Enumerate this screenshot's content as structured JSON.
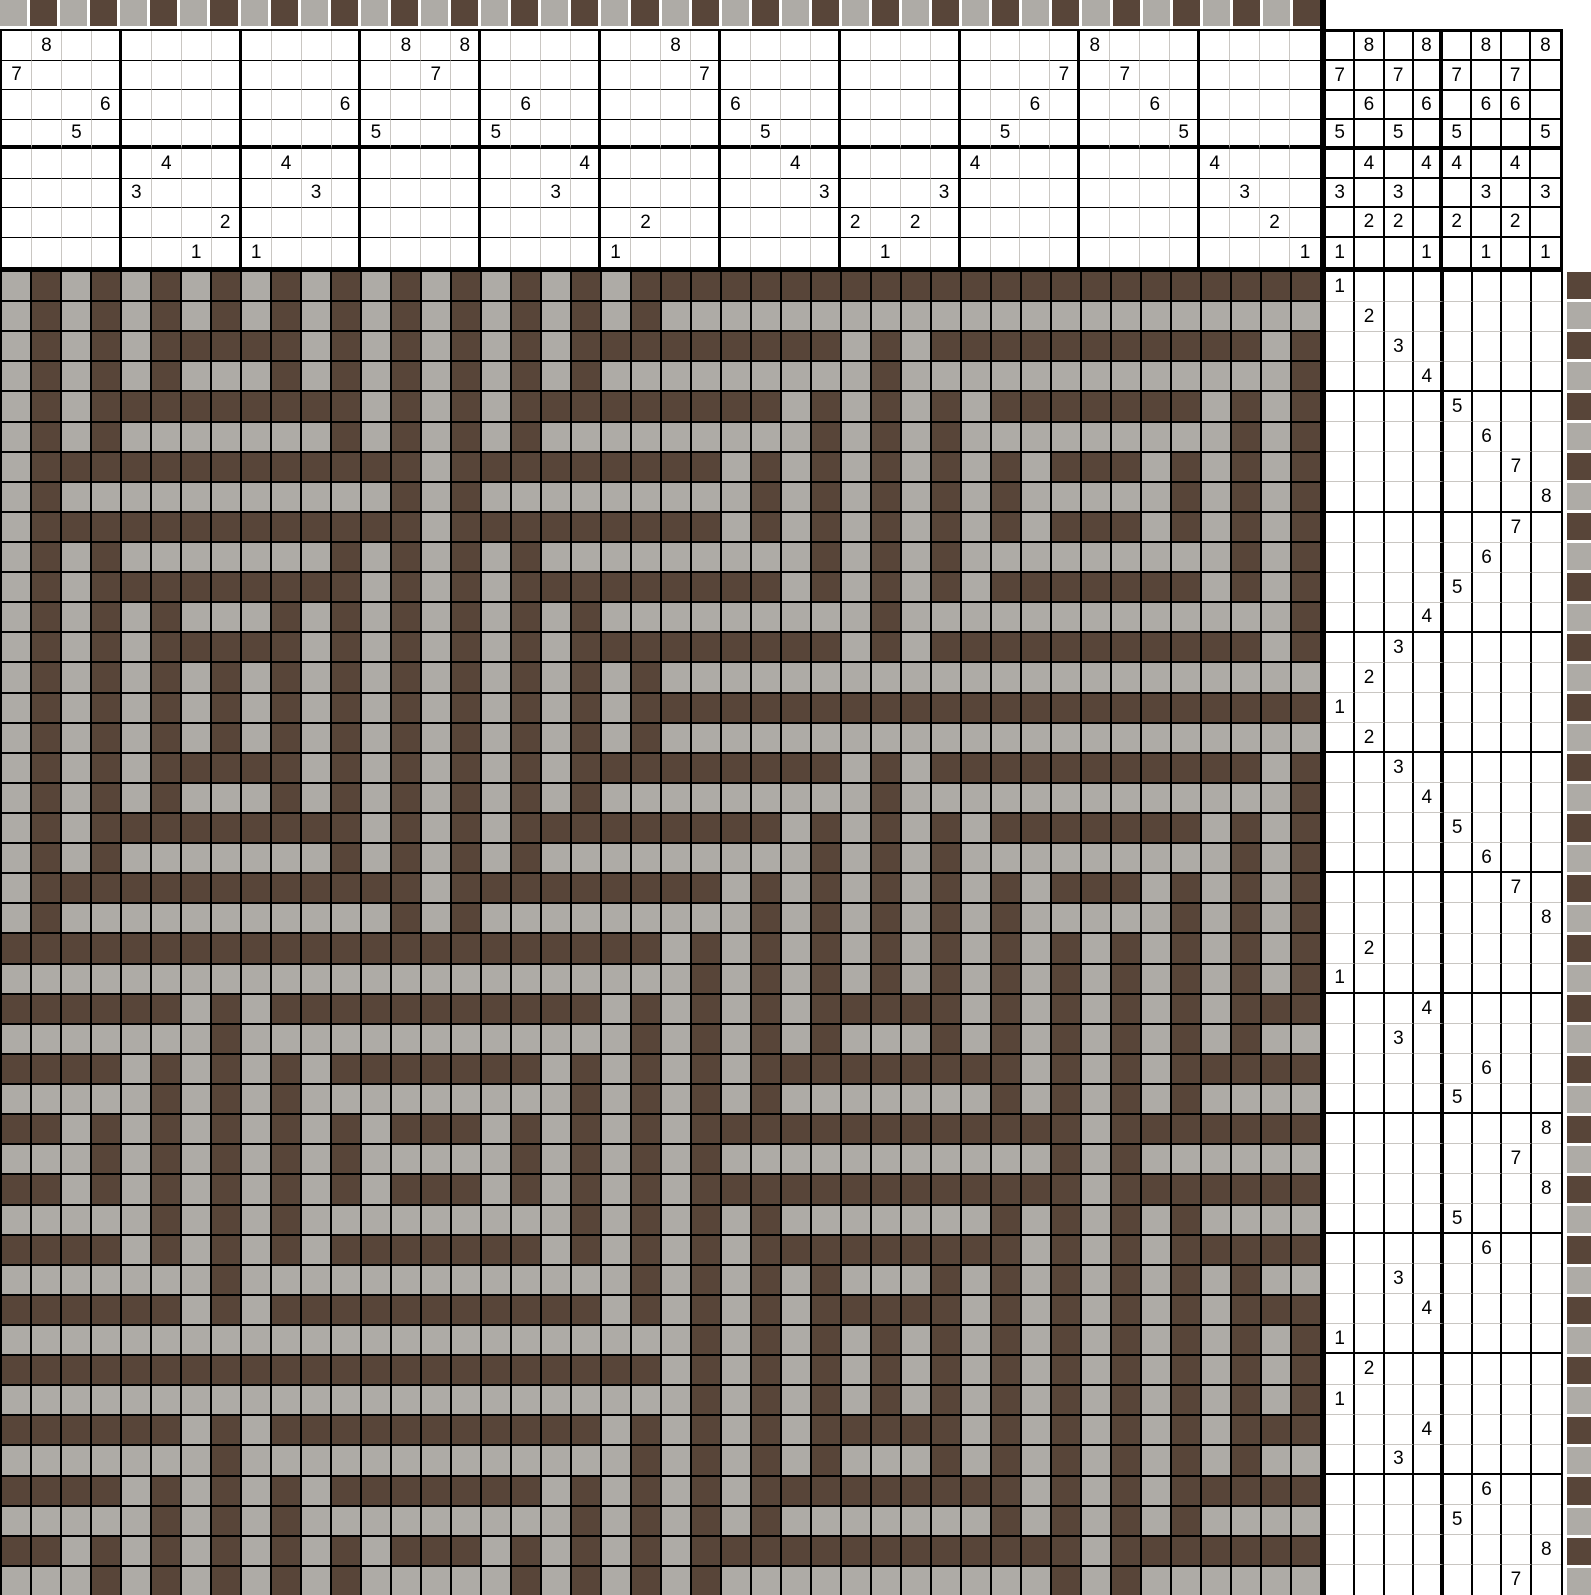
{
  "palette": {
    "brown": "#584539",
    "gray": "#AEABA6",
    "grid_dark_line": "#000000",
    "grid_light_line": "#C9C6C2",
    "background": "#FFFFFF"
  },
  "threading": {
    "shafts": 8,
    "warp_ends": 44,
    "sequence": [
      7,
      8,
      5,
      6,
      3,
      4,
      1,
      2,
      1,
      4,
      3,
      6,
      5,
      8,
      7,
      8,
      5,
      6,
      3,
      4,
      1,
      2,
      8,
      7,
      6,
      5,
      4,
      3,
      2,
      1,
      2,
      3,
      4,
      5,
      6,
      7,
      8,
      7,
      6,
      5,
      4,
      3,
      2,
      1
    ]
  },
  "tieup": {
    "treadles": 8,
    "shafts": 8,
    "marks": {
      "8": [
        2,
        4,
        6,
        8
      ],
      "7": [
        1,
        3,
        5,
        7
      ],
      "6": [
        2,
        4,
        6,
        7
      ],
      "5": [
        1,
        3,
        5,
        8
      ],
      "4": [
        2,
        4,
        5,
        7
      ],
      "3": [
        1,
        3,
        6,
        8
      ],
      "2": [
        2,
        3,
        5,
        7
      ],
      "1": [
        1,
        4,
        6,
        8
      ]
    }
  },
  "treadling": {
    "weft_picks": 44,
    "sequence": [
      1,
      2,
      3,
      4,
      5,
      6,
      7,
      8,
      7,
      6,
      5,
      4,
      3,
      2,
      1,
      2,
      3,
      4,
      5,
      6,
      7,
      8,
      2,
      1,
      4,
      3,
      6,
      5,
      8,
      7,
      8,
      5,
      6,
      3,
      4,
      1,
      2,
      1,
      4,
      3,
      6,
      5,
      8,
      7
    ]
  },
  "warp_colorbar": {
    "cycle": [
      "gray",
      "brown"
    ]
  },
  "weft_colorbar": {
    "cycle": [
      "brown",
      "gray"
    ]
  },
  "layout": {
    "group_size": 4
  }
}
